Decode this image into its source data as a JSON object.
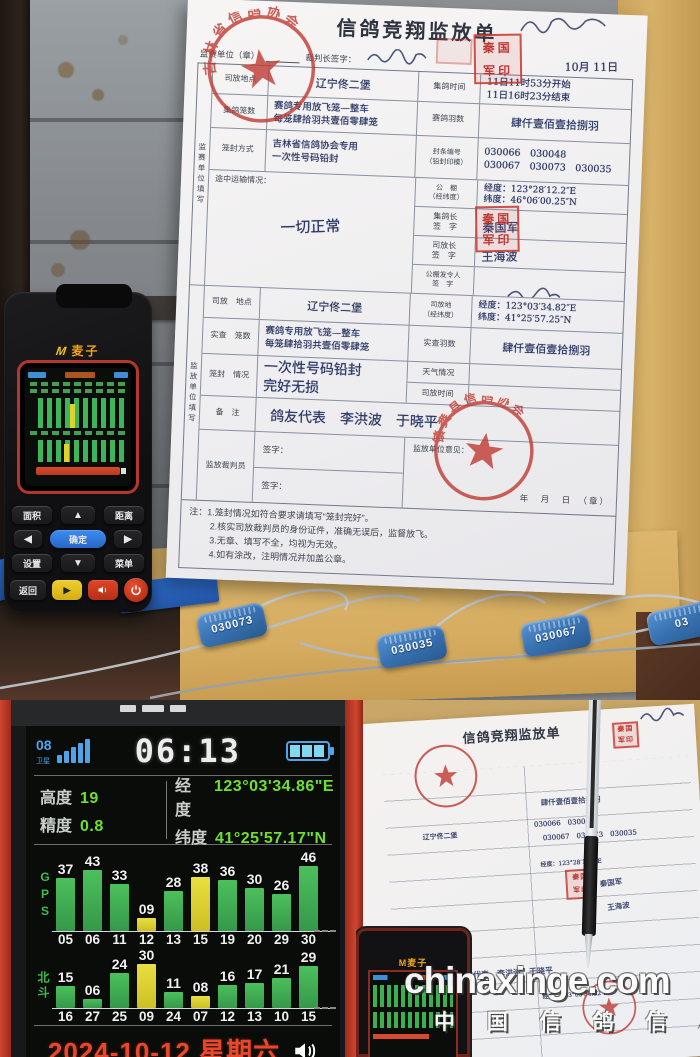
{
  "watermark": {
    "site": "chinaxinge.com",
    "cn": "中 国 信 鸽 信 息 网"
  },
  "form": {
    "title": "信鸽竞翔监放单",
    "header": {
      "unit": "监赛单位（章）",
      "judge": "裁判长签字：",
      "date_hand": "10月 11日"
    },
    "side1": "监赛单位填写",
    "side2": "监放单位填写",
    "stamps": {
      "round_top": "吉林省信鸽协会",
      "square": [
        "秦国",
        "军印"
      ],
      "round_bottom": "镇赉县信鸽协会"
    },
    "rows": {
      "site1": {
        "label": "司放地点",
        "value": "辽宁佟二堡"
      },
      "time": {
        "label": "集鸽时间",
        "l1": "11日11时53分开始",
        "l2": "11日16时23分结束"
      },
      "cages": {
        "label": "集鸽笼数",
        "l1": "赛鸽专用放飞笼—整车",
        "l2": "每笼肆拾羽共壹佰零肆笼"
      },
      "birds": {
        "label": "赛鸽羽数",
        "value": "肆仟壹佰壹拾捌羽"
      },
      "sealmode": {
        "label": "笼封方式",
        "l1": "吉林省信鸽协会专用",
        "l2": "一次性号码铅封"
      },
      "sealno": {
        "label": "封条编号\n（铅封印模）",
        "l1": "030066　030048",
        "l2": "030067　030073　030035"
      },
      "transport": {
        "label": "途中运输情况：",
        "value": "一切正常"
      },
      "loft": {
        "label": "公　棚\n（经纬度）",
        "lng": "经度：123°28′12.2″E",
        "lat": "纬度：46°06′00.25″N"
      },
      "jgz": {
        "label": "集鸽长\n签　字",
        "value": "秦国军"
      },
      "sfz": {
        "label": "司放长\n签　字",
        "value": "王海波"
      },
      "flr": {
        "label": "公棚发令人\n签　字"
      },
      "site2": {
        "label": "司放　地点",
        "value": "辽宁佟二堡"
      },
      "sitegeo": {
        "label": "司放地\n（经纬度）",
        "lng": "经度：123°03′34.82″E",
        "lat": "纬度：41°25′57.25″N"
      },
      "cages2": {
        "label": "实查　笼数",
        "l1": "赛鸽专用放飞笼—整车",
        "l2": "每笼肆拾羽共壹佰零肆笼"
      },
      "birds2": {
        "label": "实查羽数",
        "value": "肆仟壹佰壹拾捌羽"
      },
      "sealstate": {
        "label": "笼封　情况",
        "l1": "一次性号码铅封",
        "l2": "完好无损"
      },
      "weather": {
        "label": "天气情况",
        "value": ""
      },
      "rtime": {
        "label": "司放时间",
        "value": ""
      },
      "remark": {
        "label": "备　注",
        "value": "鸽友代表　李洪波　于晓平"
      },
      "referee": {
        "label": "监放裁判员",
        "sign1": "签字：",
        "sign2": "签字："
      },
      "opinion": {
        "label": "监放单位意见：",
        "date_line": "年　月　日　（章）"
      }
    },
    "notes": [
      "注：1.笼封情况如符合要求请填写“笼封完好”。",
      "2.核实司放裁判员的身份证件，准确无误后，监督放飞。",
      "3.无章、填写不全，均视为无效。",
      "4.如有涂改，注明情况并加盖公章。"
    ]
  },
  "seal_tags": [
    "030073",
    "030035",
    "030067",
    "03"
  ],
  "device": {
    "brand": "麦子",
    "keys": {
      "area": "面积",
      "distance": "距离",
      "ok": "确定",
      "settings": "设置",
      "menu": "菜单",
      "back": "返回",
      "up": "▲",
      "down": "▼",
      "left": "◀",
      "right": "▶",
      "play": "▶"
    }
  },
  "gps": {
    "sat_count": "08",
    "sat_label": "卫星",
    "time": "06:13",
    "alt_label": "高度",
    "alt": "19",
    "acc_label": "精度",
    "acc": "0.8",
    "lng_label": "经度",
    "lng": "123°03'34.86\"E",
    "lat_label": "纬度",
    "lat": "41°25'57.17\"N",
    "gps_axis": "GPS",
    "beidou_axis": "北斗",
    "gps_bars": {
      "sats": [
        "05",
        "06",
        "11",
        "12",
        "13",
        "15",
        "19",
        "20",
        "29",
        "30"
      ],
      "values": [
        "37",
        "43",
        "33",
        "09",
        "28",
        "38",
        "36",
        "30",
        "26",
        "46"
      ],
      "yellow": [
        3,
        5
      ]
    },
    "beidou_bars": {
      "sats": [
        "16",
        "27",
        "25",
        "09",
        "24",
        "07",
        "12",
        "13",
        "10",
        "15"
      ],
      "values": [
        "15",
        "06",
        "24",
        "30",
        "11",
        "08",
        "16",
        "17",
        "21",
        "29"
      ],
      "yellow": [
        3,
        5
      ]
    },
    "date": "2024-10-12 星期六"
  },
  "colors": {
    "seal_red": "#c03a32",
    "bar_green": "#43b854",
    "bar_yellow": "#ddd32f",
    "value_green": "#6fe02e",
    "date_red": "#e84b2a",
    "device_red": "#c0392b",
    "header_blue": "#4fa3e8",
    "envelope_tan": "#d7b269"
  }
}
